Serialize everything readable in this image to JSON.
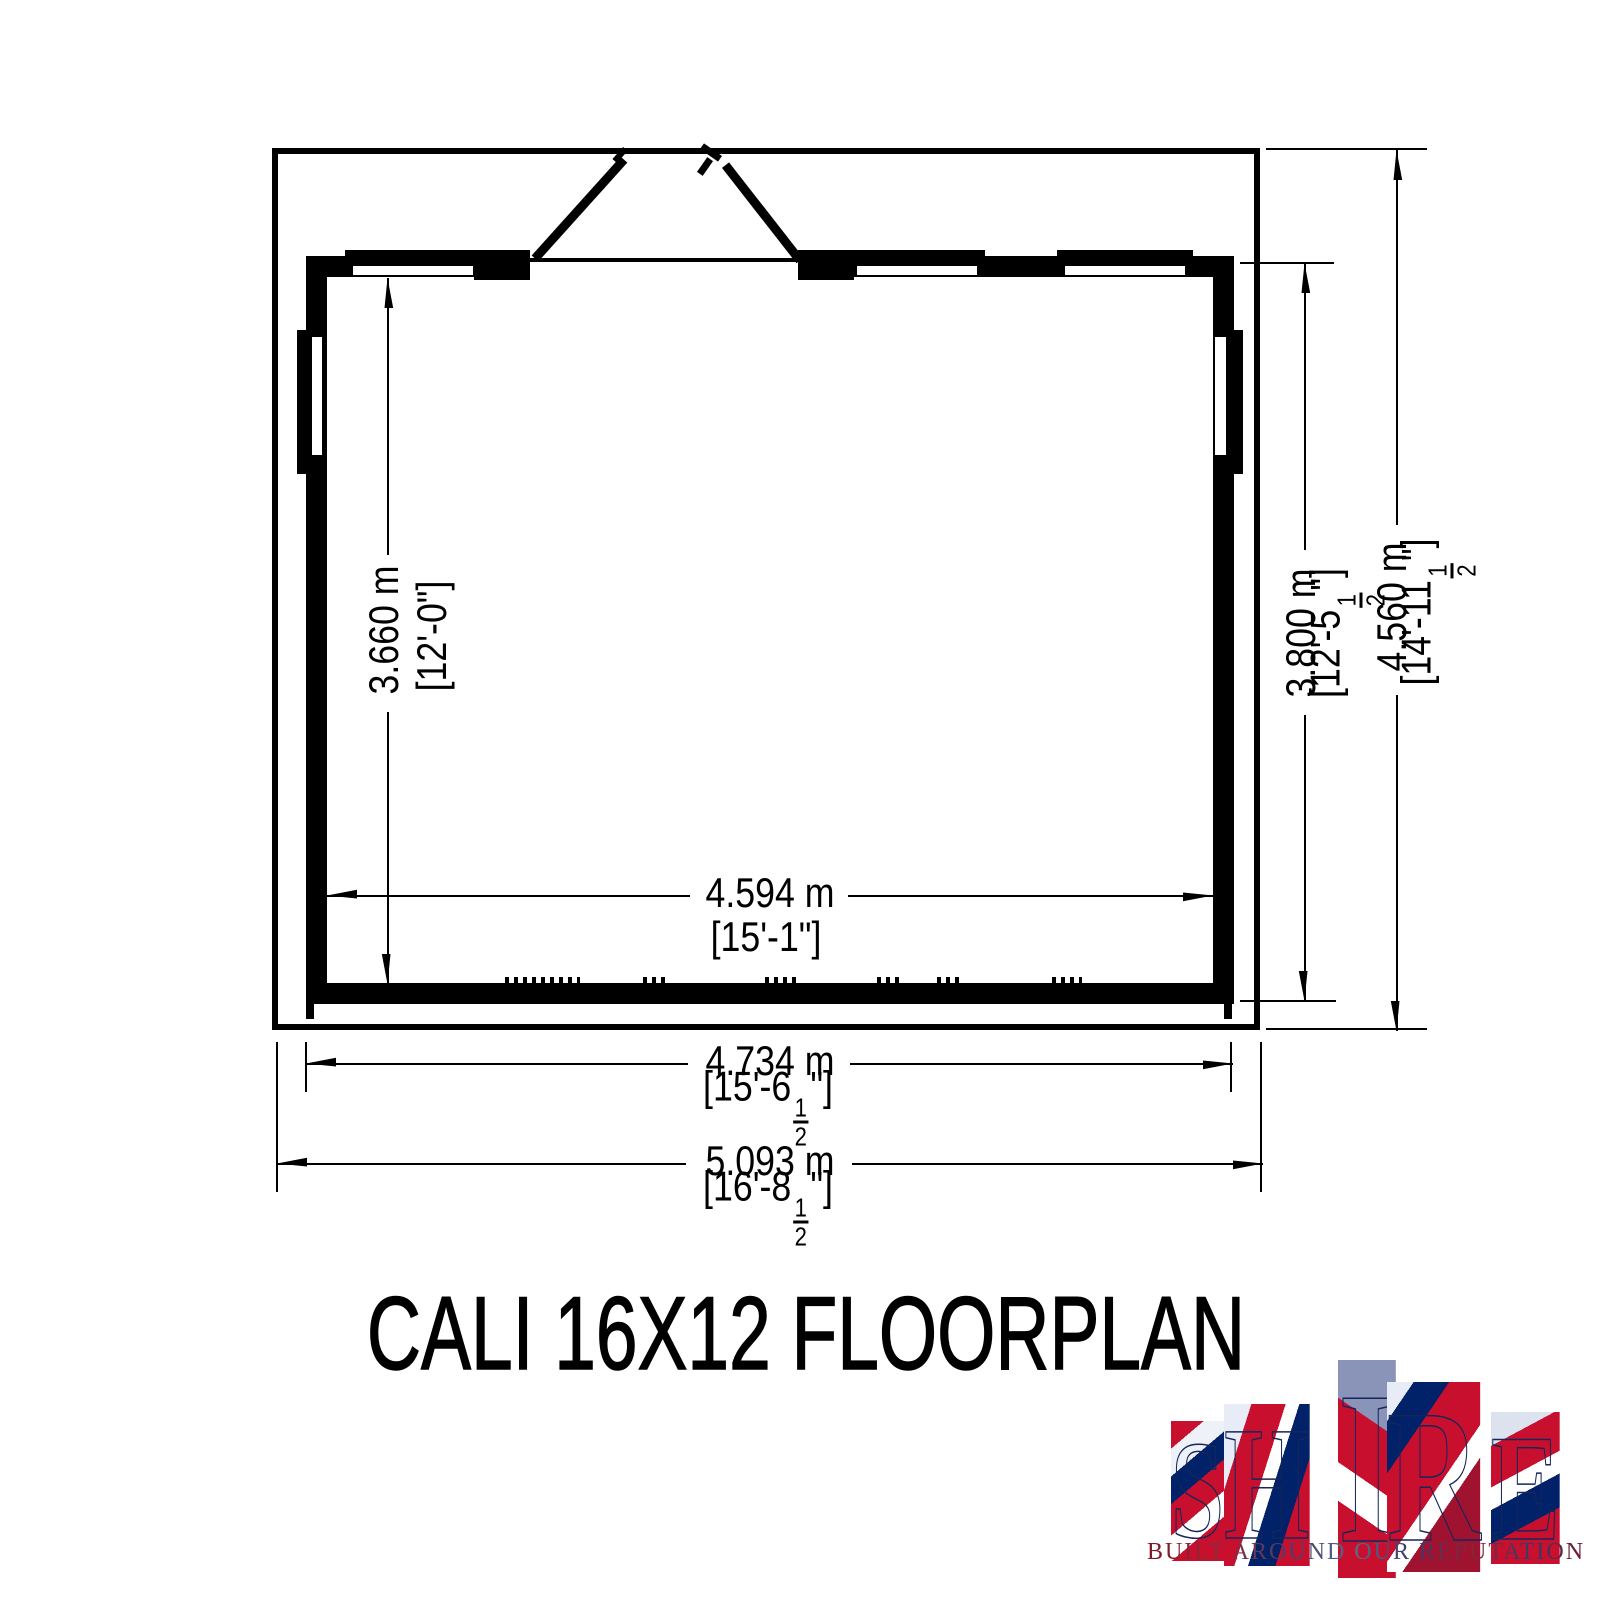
{
  "colors": {
    "ink": "#000000",
    "paper": "#ffffff",
    "logo_red": "#c8102e",
    "logo_blue": "#012169",
    "logo_outline": "#15265a"
  },
  "title": "CALI 16X12 FLOORPLAN",
  "dimensions": {
    "interior_depth": {
      "metric": "3.660 m",
      "imperial": "[12'-0\"]"
    },
    "building_depth": {
      "metric": "3.800 m",
      "imperial_pre": "[12'-5",
      "fraction_numerator": "1",
      "fraction_denominator": "2",
      "imperial_post": "\"]"
    },
    "overall_depth": {
      "metric": "4.560 m",
      "imperial_pre": "[14'-11",
      "fraction_numerator": "1",
      "fraction_denominator": "2",
      "imperial_post": "\"]"
    },
    "interior_width": {
      "metric": "4.594 m",
      "imperial": "[15'-1\"]"
    },
    "building_width": {
      "metric": "4.734 m",
      "imperial_pre": "[15'-6",
      "fraction_numerator": "1",
      "fraction_denominator": "2",
      "imperial_post": "\"]"
    },
    "overall_width": {
      "metric": "5.093 m",
      "imperial_pre": "[16'-8",
      "fraction_numerator": "1",
      "fraction_denominator": "2",
      "imperial_post": "\"]"
    }
  },
  "logo": {
    "letters": [
      "S",
      "H",
      "I",
      "R",
      "E"
    ],
    "tagline": "BUILT AROUND OUR REPUTATION"
  }
}
